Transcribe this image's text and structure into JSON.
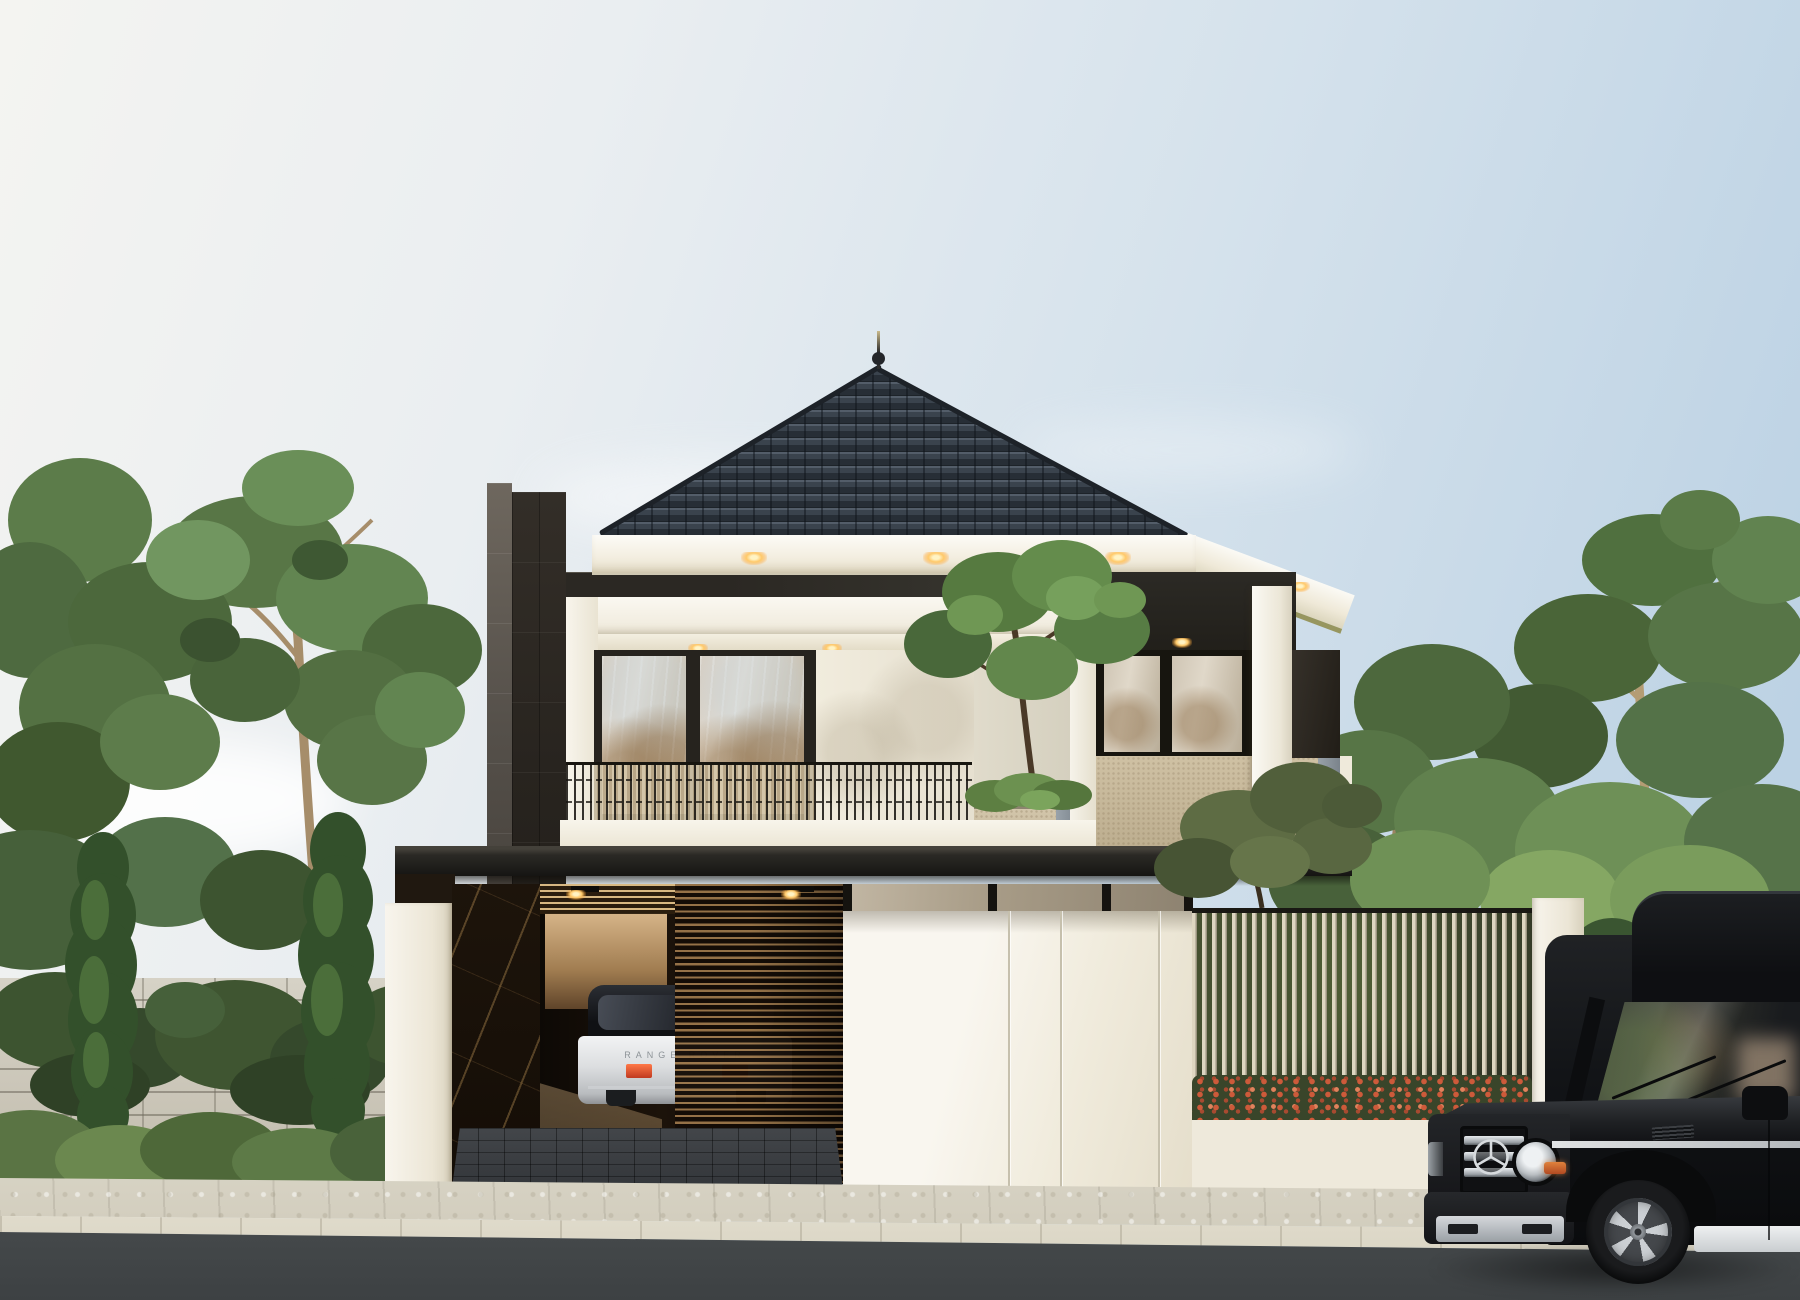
{
  "scene": {
    "kind": "exterior-render-modern-two-story-house"
  },
  "palette": {
    "sky_left": "#f4f4f1",
    "sky_right": "#b6cee2",
    "roof_tile": "#3a434d",
    "fascia_white": "#f4efe2",
    "wall_white": "#f3f0e7",
    "stone_pillar": "#55504a",
    "canopy_dark": "#1d1c19",
    "planter_beige": "#cfc1a4",
    "wood_slat": "#997549",
    "flower_hedge": "#cd5a3a",
    "foliage_green": "#587245",
    "asphalt": "#4a4e50",
    "downlight": "#ffc96a"
  },
  "vehicles": {
    "garage_car": {
      "badge_text": "RANGE ROVER",
      "body_color": "#e8e9ea",
      "roof_color": "#15161a"
    },
    "street_car": {
      "emblem": "mercedes-star",
      "body_color": "#141518"
    }
  }
}
